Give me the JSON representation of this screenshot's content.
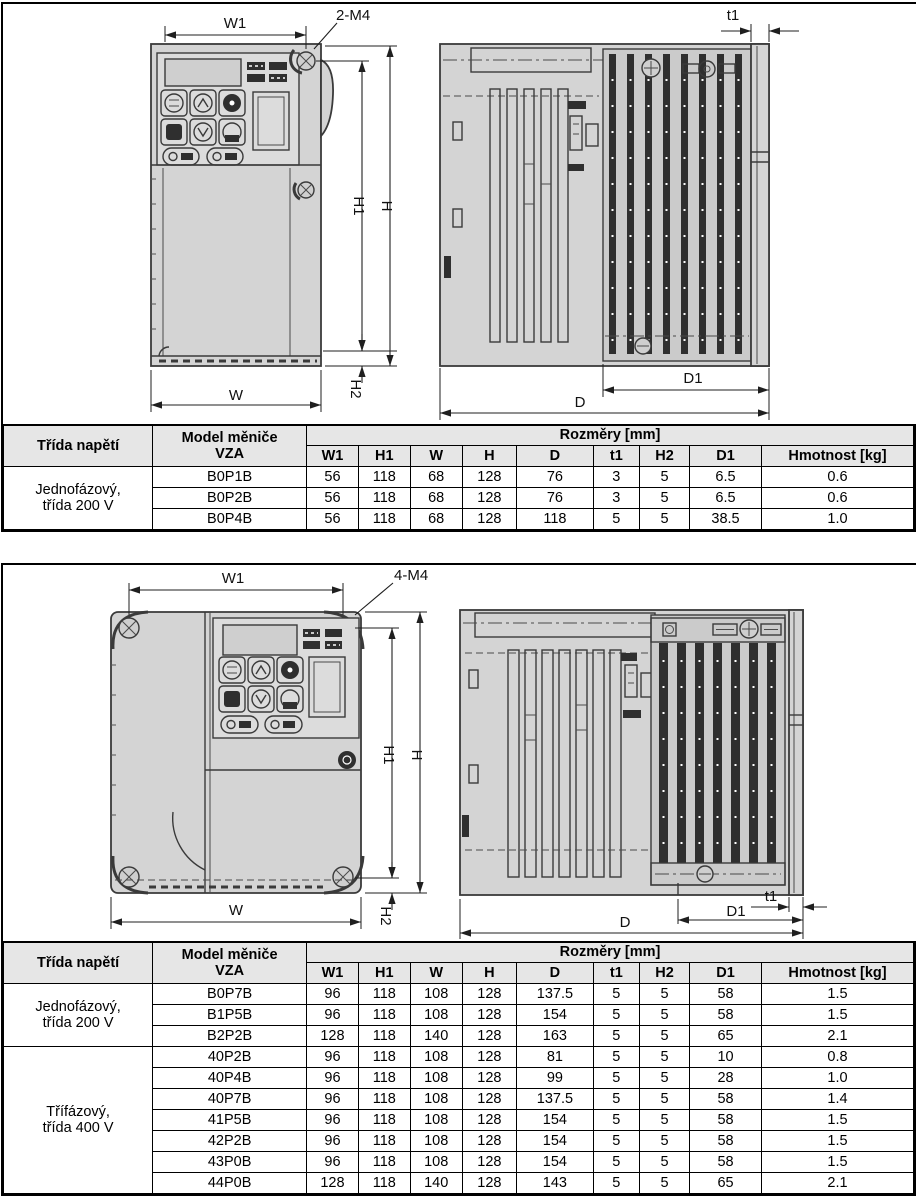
{
  "colors": {
    "drawing_body_gray": "#d4d4d4",
    "drawing_line": "#3a3a3a",
    "heatsink_fin_dark": "#2f2f2f",
    "table_header_bg": "#e6e6e6"
  },
  "figure1": {
    "dim_labels": {
      "w1": "W1",
      "m4": "2-M4",
      "t1": "t1",
      "h1": "H1",
      "h": "H",
      "h2": "H2",
      "w": "W",
      "d1": "D1",
      "d": "D"
    }
  },
  "figure2": {
    "dim_labels": {
      "w1": "W1",
      "m4": "4-M4",
      "t1": "t1",
      "h1": "H1",
      "h": "H",
      "h2": "H2",
      "w": "W",
      "d1": "D1",
      "d": "D"
    }
  },
  "table_headers": {
    "voltage_class": "Třída napětí",
    "model_line1": "Model měniče",
    "model_line2": "VZA",
    "dimensions": "Rozměry [mm]",
    "dim_columns": [
      "W1",
      "H1",
      "W",
      "H",
      "D",
      "t1",
      "H2",
      "D1"
    ],
    "weight": "Hmotnost [kg]"
  },
  "table1": {
    "groups": [
      {
        "label_line1": "Jednofázový,",
        "label_line2": "třída 200 V",
        "rows": [
          {
            "model": "B0P1B",
            "values": [
              "56",
              "118",
              "68",
              "128",
              "76",
              "3",
              "5",
              "6.5",
              "0.6"
            ]
          },
          {
            "model": "B0P2B",
            "values": [
              "56",
              "118",
              "68",
              "128",
              "76",
              "3",
              "5",
              "6.5",
              "0.6"
            ]
          },
          {
            "model": "B0P4B",
            "values": [
              "56",
              "118",
              "68",
              "128",
              "118",
              "5",
              "5",
              "38.5",
              "1.0"
            ]
          }
        ]
      }
    ]
  },
  "table2": {
    "groups": [
      {
        "label_line1": "Jednofázový,",
        "label_line2": "třída 200 V",
        "rows": [
          {
            "model": "B0P7B",
            "values": [
              "96",
              "118",
              "108",
              "128",
              "137.5",
              "5",
              "5",
              "58",
              "1.5"
            ]
          },
          {
            "model": "B1P5B",
            "values": [
              "96",
              "118",
              "108",
              "128",
              "154",
              "5",
              "5",
              "58",
              "1.5"
            ]
          },
          {
            "model": "B2P2B",
            "values": [
              "128",
              "118",
              "140",
              "128",
              "163",
              "5",
              "5",
              "65",
              "2.1"
            ]
          }
        ]
      },
      {
        "label_line1": "Třífázový,",
        "label_line2": "třída 400 V",
        "rows": [
          {
            "model": "40P2B",
            "values": [
              "96",
              "118",
              "108",
              "128",
              "81",
              "5",
              "5",
              "10",
              "0.8"
            ]
          },
          {
            "model": "40P4B",
            "values": [
              "96",
              "118",
              "108",
              "128",
              "99",
              "5",
              "5",
              "28",
              "1.0"
            ]
          },
          {
            "model": "40P7B",
            "values": [
              "96",
              "118",
              "108",
              "128",
              "137.5",
              "5",
              "5",
              "58",
              "1.4"
            ]
          },
          {
            "model": "41P5B",
            "values": [
              "96",
              "118",
              "108",
              "128",
              "154",
              "5",
              "5",
              "58",
              "1.5"
            ]
          },
          {
            "model": "42P2B",
            "values": [
              "96",
              "118",
              "108",
              "128",
              "154",
              "5",
              "5",
              "58",
              "1.5"
            ]
          },
          {
            "model": "43P0B",
            "values": [
              "96",
              "118",
              "108",
              "128",
              "154",
              "5",
              "5",
              "58",
              "1.5"
            ]
          },
          {
            "model": "44P0B",
            "values": [
              "128",
              "118",
              "140",
              "128",
              "143",
              "5",
              "5",
              "65",
              "2.1"
            ]
          }
        ]
      }
    ]
  }
}
